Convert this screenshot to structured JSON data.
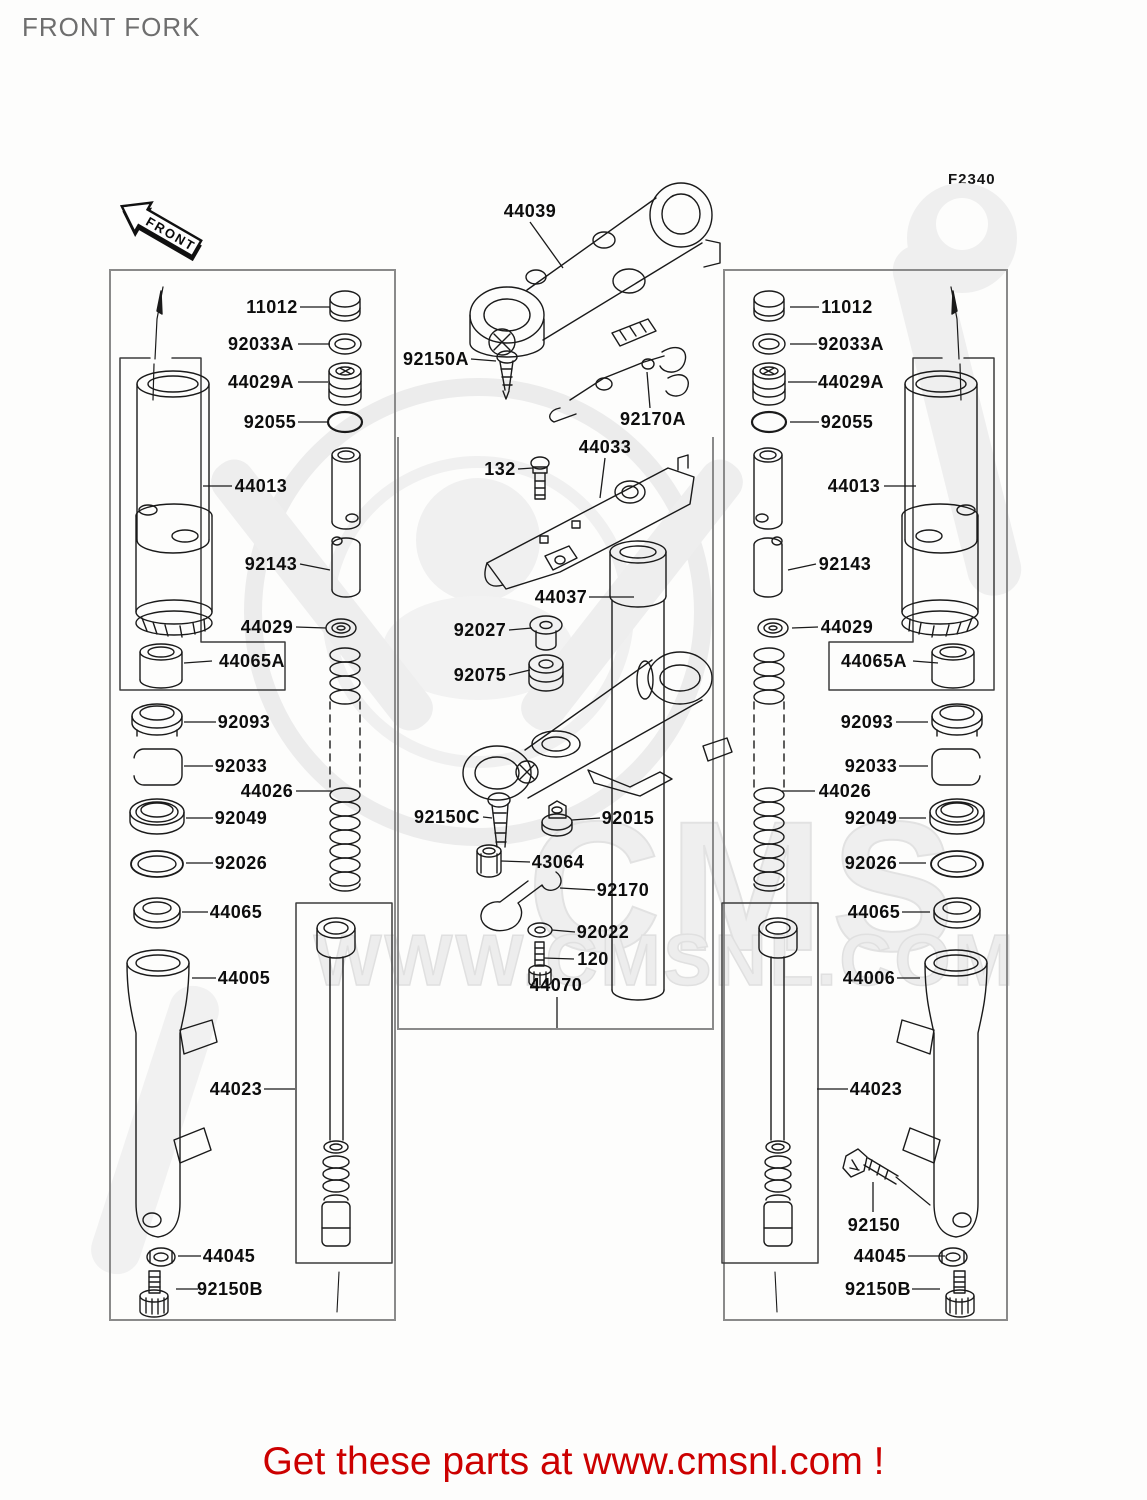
{
  "header": {
    "title": "FRONT FORK",
    "diagram_code": "F2340"
  },
  "front_arrow_label": "FRONT",
  "watermark": {
    "logo_text": "CMS",
    "url_text": "WWW.CMSNL.COM"
  },
  "banner": {
    "text": "Get these parts at www.cmsnl.com !",
    "color": "#cc0000"
  },
  "colors": {
    "line": "#1a1a1a",
    "box_border": "#8a8a8a",
    "label": "#0d0d0d",
    "watermark": "#ececec"
  },
  "parts": [
    {
      "ref": "11012",
      "x": 272,
      "y": 307,
      "leader": [
        300,
        307,
        330,
        307
      ]
    },
    {
      "ref": "92033A",
      "x": 261,
      "y": 344,
      "leader": [
        298,
        344,
        330,
        344
      ]
    },
    {
      "ref": "44029A",
      "x": 261,
      "y": 382,
      "leader": [
        298,
        382,
        328,
        382
      ]
    },
    {
      "ref": "92055",
      "x": 270,
      "y": 422,
      "leader": [
        298,
        422,
        328,
        422
      ]
    },
    {
      "ref": "44013",
      "x": 261,
      "y": 486,
      "leader": [
        232,
        486,
        203,
        486
      ]
    },
    {
      "ref": "92143",
      "x": 271,
      "y": 564,
      "leader": [
        300,
        564,
        330,
        570
      ]
    },
    {
      "ref": "44029",
      "x": 267,
      "y": 627,
      "leader": [
        296,
        627,
        326,
        628
      ]
    },
    {
      "ref": "44065A",
      "x": 252,
      "y": 661,
      "leader": [
        212,
        661,
        184,
        663
      ]
    },
    {
      "ref": "92093",
      "x": 244,
      "y": 722,
      "leader": [
        216,
        722,
        184,
        722
      ]
    },
    {
      "ref": "92033",
      "x": 241,
      "y": 766,
      "leader": [
        213,
        766,
        184,
        766
      ]
    },
    {
      "ref": "44026",
      "x": 267,
      "y": 791,
      "leader": [
        296,
        791,
        332,
        791
      ]
    },
    {
      "ref": "92049",
      "x": 241,
      "y": 818,
      "leader": [
        213,
        818,
        186,
        818
      ]
    },
    {
      "ref": "92026",
      "x": 241,
      "y": 863,
      "leader": [
        213,
        863,
        186,
        863
      ]
    },
    {
      "ref": "44065",
      "x": 236,
      "y": 912,
      "leader": [
        208,
        912,
        182,
        912
      ]
    },
    {
      "ref": "44005",
      "x": 244,
      "y": 978,
      "leader": [
        216,
        978,
        192,
        978
      ]
    },
    {
      "ref": "44023",
      "x": 236,
      "y": 1089,
      "leader": [
        264,
        1089,
        295,
        1089
      ]
    },
    {
      "ref": "44045",
      "x": 229,
      "y": 1256,
      "leader": [
        201,
        1256,
        178,
        1256
      ]
    },
    {
      "ref": "92150B",
      "x": 230,
      "y": 1289,
      "leader": [
        198,
        1289,
        176,
        1289
      ]
    },
    {
      "ref": "11012",
      "x": 847,
      "y": 307,
      "leader": [
        819,
        307,
        790,
        307
      ]
    },
    {
      "ref": "92033A",
      "x": 851,
      "y": 344,
      "leader": [
        817,
        344,
        790,
        344
      ]
    },
    {
      "ref": "44029A",
      "x": 851,
      "y": 382,
      "leader": [
        817,
        382,
        788,
        382
      ]
    },
    {
      "ref": "92055",
      "x": 847,
      "y": 422,
      "leader": [
        819,
        422,
        790,
        422
      ]
    },
    {
      "ref": "44013",
      "x": 854,
      "y": 486,
      "leader": [
        884,
        486,
        916,
        486
      ]
    },
    {
      "ref": "92143",
      "x": 845,
      "y": 564,
      "leader": [
        816,
        564,
        788,
        570
      ]
    },
    {
      "ref": "44029",
      "x": 847,
      "y": 627,
      "leader": [
        818,
        627,
        792,
        628
      ]
    },
    {
      "ref": "44065A",
      "x": 874,
      "y": 661,
      "leader": [
        913,
        661,
        938,
        663
      ]
    },
    {
      "ref": "92093",
      "x": 867,
      "y": 722,
      "leader": [
        896,
        722,
        928,
        722
      ]
    },
    {
      "ref": "92033",
      "x": 871,
      "y": 766,
      "leader": [
        899,
        766,
        928,
        766
      ]
    },
    {
      "ref": "44026",
      "x": 845,
      "y": 791,
      "leader": [
        815,
        791,
        782,
        791
      ]
    },
    {
      "ref": "92049",
      "x": 871,
      "y": 818,
      "leader": [
        899,
        818,
        926,
        818
      ]
    },
    {
      "ref": "92026",
      "x": 871,
      "y": 863,
      "leader": [
        899,
        863,
        926,
        863
      ]
    },
    {
      "ref": "44065",
      "x": 874,
      "y": 912,
      "leader": [
        902,
        912,
        930,
        912
      ]
    },
    {
      "ref": "44006",
      "x": 869,
      "y": 978,
      "leader": [
        897,
        978,
        920,
        978
      ]
    },
    {
      "ref": "44023",
      "x": 876,
      "y": 1089,
      "leader": [
        848,
        1089,
        817,
        1089
      ]
    },
    {
      "ref": "92150",
      "x": 874,
      "y": 1225,
      "leader": [
        873,
        1212,
        873,
        1182
      ]
    },
    {
      "ref": "44045",
      "x": 880,
      "y": 1256,
      "leader": [
        908,
        1256,
        945,
        1256
      ]
    },
    {
      "ref": "92150B",
      "x": 878,
      "y": 1289,
      "leader": [
        912,
        1289,
        940,
        1289
      ]
    },
    {
      "ref": "44039",
      "x": 530,
      "y": 211,
      "leader": [
        530,
        222,
        563,
        268
      ]
    },
    {
      "ref": "92150A",
      "x": 436,
      "y": 359,
      "leader": [
        471,
        359,
        496,
        361
      ]
    },
    {
      "ref": "92170A",
      "x": 653,
      "y": 419,
      "leader": [
        650,
        408,
        647,
        372
      ]
    },
    {
      "ref": "44033",
      "x": 605,
      "y": 447,
      "leader": [
        605,
        458,
        600,
        498
      ]
    },
    {
      "ref": "132",
      "x": 500,
      "y": 469,
      "leader": [
        518,
        469,
        533,
        468
      ]
    },
    {
      "ref": "44037",
      "x": 561,
      "y": 597,
      "leader": [
        589,
        597,
        634,
        597
      ]
    },
    {
      "ref": "92027",
      "x": 480,
      "y": 630,
      "leader": [
        509,
        630,
        532,
        628
      ]
    },
    {
      "ref": "92075",
      "x": 480,
      "y": 675,
      "leader": [
        509,
        675,
        530,
        670
      ]
    },
    {
      "ref": "92150C",
      "x": 447,
      "y": 817,
      "leader": [
        483,
        817,
        492,
        818
      ]
    },
    {
      "ref": "92015",
      "x": 628,
      "y": 818,
      "leader": [
        600,
        818,
        572,
        820
      ]
    },
    {
      "ref": "43064",
      "x": 558,
      "y": 862,
      "leader": [
        530,
        862,
        501,
        861
      ]
    },
    {
      "ref": "92170",
      "x": 623,
      "y": 890,
      "leader": [
        595,
        890,
        560,
        888
      ]
    },
    {
      "ref": "92022",
      "x": 603,
      "y": 932,
      "leader": [
        575,
        932,
        552,
        930
      ]
    },
    {
      "ref": "120",
      "x": 593,
      "y": 959,
      "leader": [
        574,
        959,
        544,
        958
      ]
    },
    {
      "ref": "44070",
      "x": 556,
      "y": 985,
      "leader": [
        557,
        997,
        557,
        1028
      ]
    }
  ]
}
